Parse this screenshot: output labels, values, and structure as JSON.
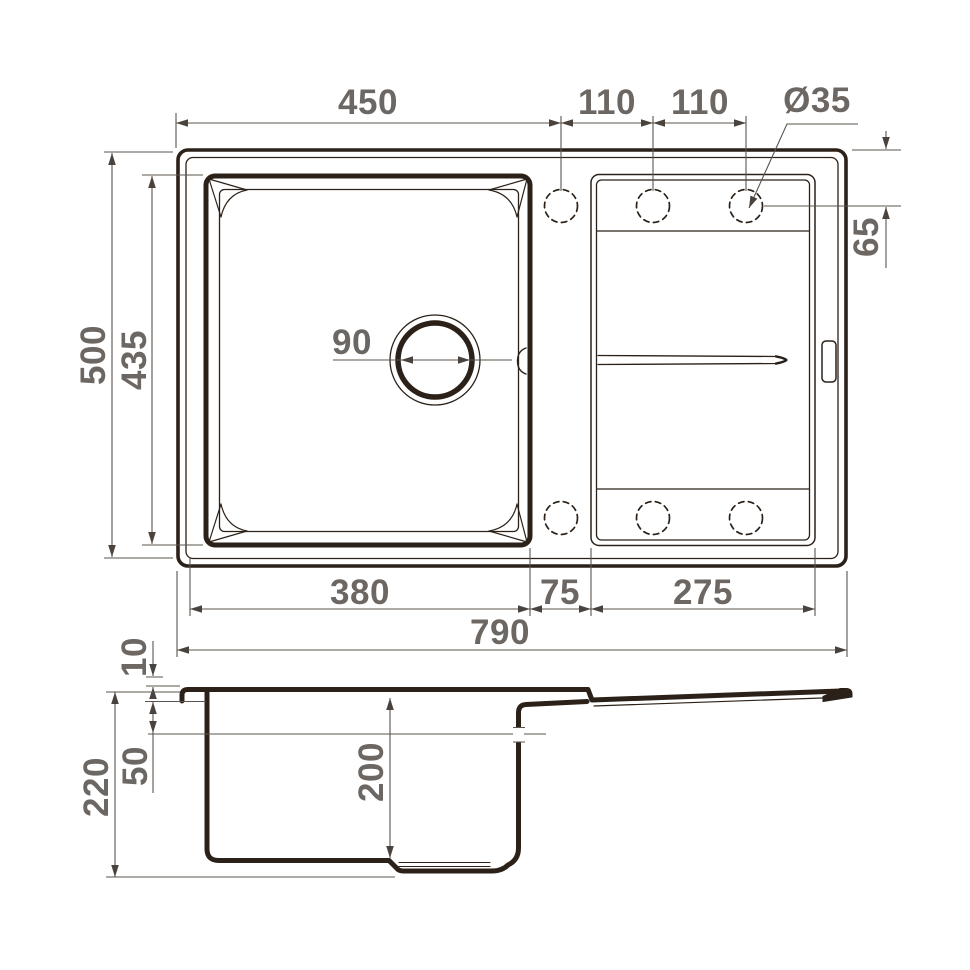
{
  "drawing": {
    "type": "technical-dimension-drawing",
    "subject": "kitchen sink with drainboard, top view and side section",
    "colors": {
      "outline": "#2b2118",
      "dim_line": "#5b544e",
      "dim_text": "#6c6763",
      "background": "#ffffff"
    },
    "top_view": {
      "dims": {
        "cutout_to_first_hole": "450",
        "hole_spacing_a": "110",
        "hole_spacing_b": "110",
        "tap_hole_diameter": "Ø35",
        "overall_depth": "500",
        "bowl_cutout_depth": "435",
        "drain_diameter": "90",
        "hole_edge_offset": "65",
        "bowl_width": "380",
        "center_strip_width": "75",
        "drainboard_width": "275",
        "overall_width": "790"
      },
      "tap_hole_count": 6,
      "drain_position": "center of main bowl"
    },
    "side_view": {
      "dims": {
        "rim_height": "10",
        "overflow_level": "50",
        "overall_height": "220",
        "bowl_depth": "200"
      }
    }
  }
}
